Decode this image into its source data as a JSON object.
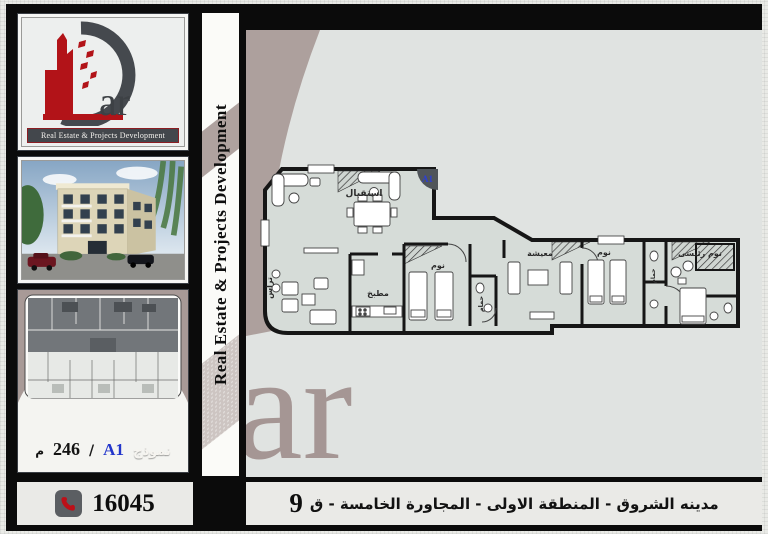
{
  "brand": {
    "suffix": "ar",
    "tagline": "Real Estate & Projects Development",
    "watermark": "ar"
  },
  "strip": {
    "text": "Real Estate & Projects Development"
  },
  "model_panel": {
    "model_word": "نموذج",
    "model_code": "A1",
    "separator": "/",
    "area": "246",
    "area_unit": "م"
  },
  "plan": {
    "unit_label": "A1",
    "rooms": [
      {
        "name": "reception",
        "label": "استقبال"
      },
      {
        "name": "terrace",
        "label": "تراس"
      },
      {
        "name": "kitchen",
        "label": "مطبخ"
      },
      {
        "name": "bedroom-1",
        "label": "نوم"
      },
      {
        "name": "bath-1",
        "label": "حمام"
      },
      {
        "name": "living",
        "label": "معيشة"
      },
      {
        "name": "bedroom-2",
        "label": "نوم"
      },
      {
        "name": "bath-2",
        "label": "حمام"
      },
      {
        "name": "master-bedroom",
        "label": "نوم رئيسى"
      }
    ]
  },
  "footer": {
    "phone": "16045",
    "location": "مدينه الشروق - المنطقة الاولى  -  المجاورة الخامسة - ق",
    "plot_number": "9"
  },
  "colors": {
    "accent_red": "#b21318",
    "mauve": "#a89a97",
    "unit_blue": "#2d3fd4",
    "plan_floor": "#d6dcd8"
  }
}
